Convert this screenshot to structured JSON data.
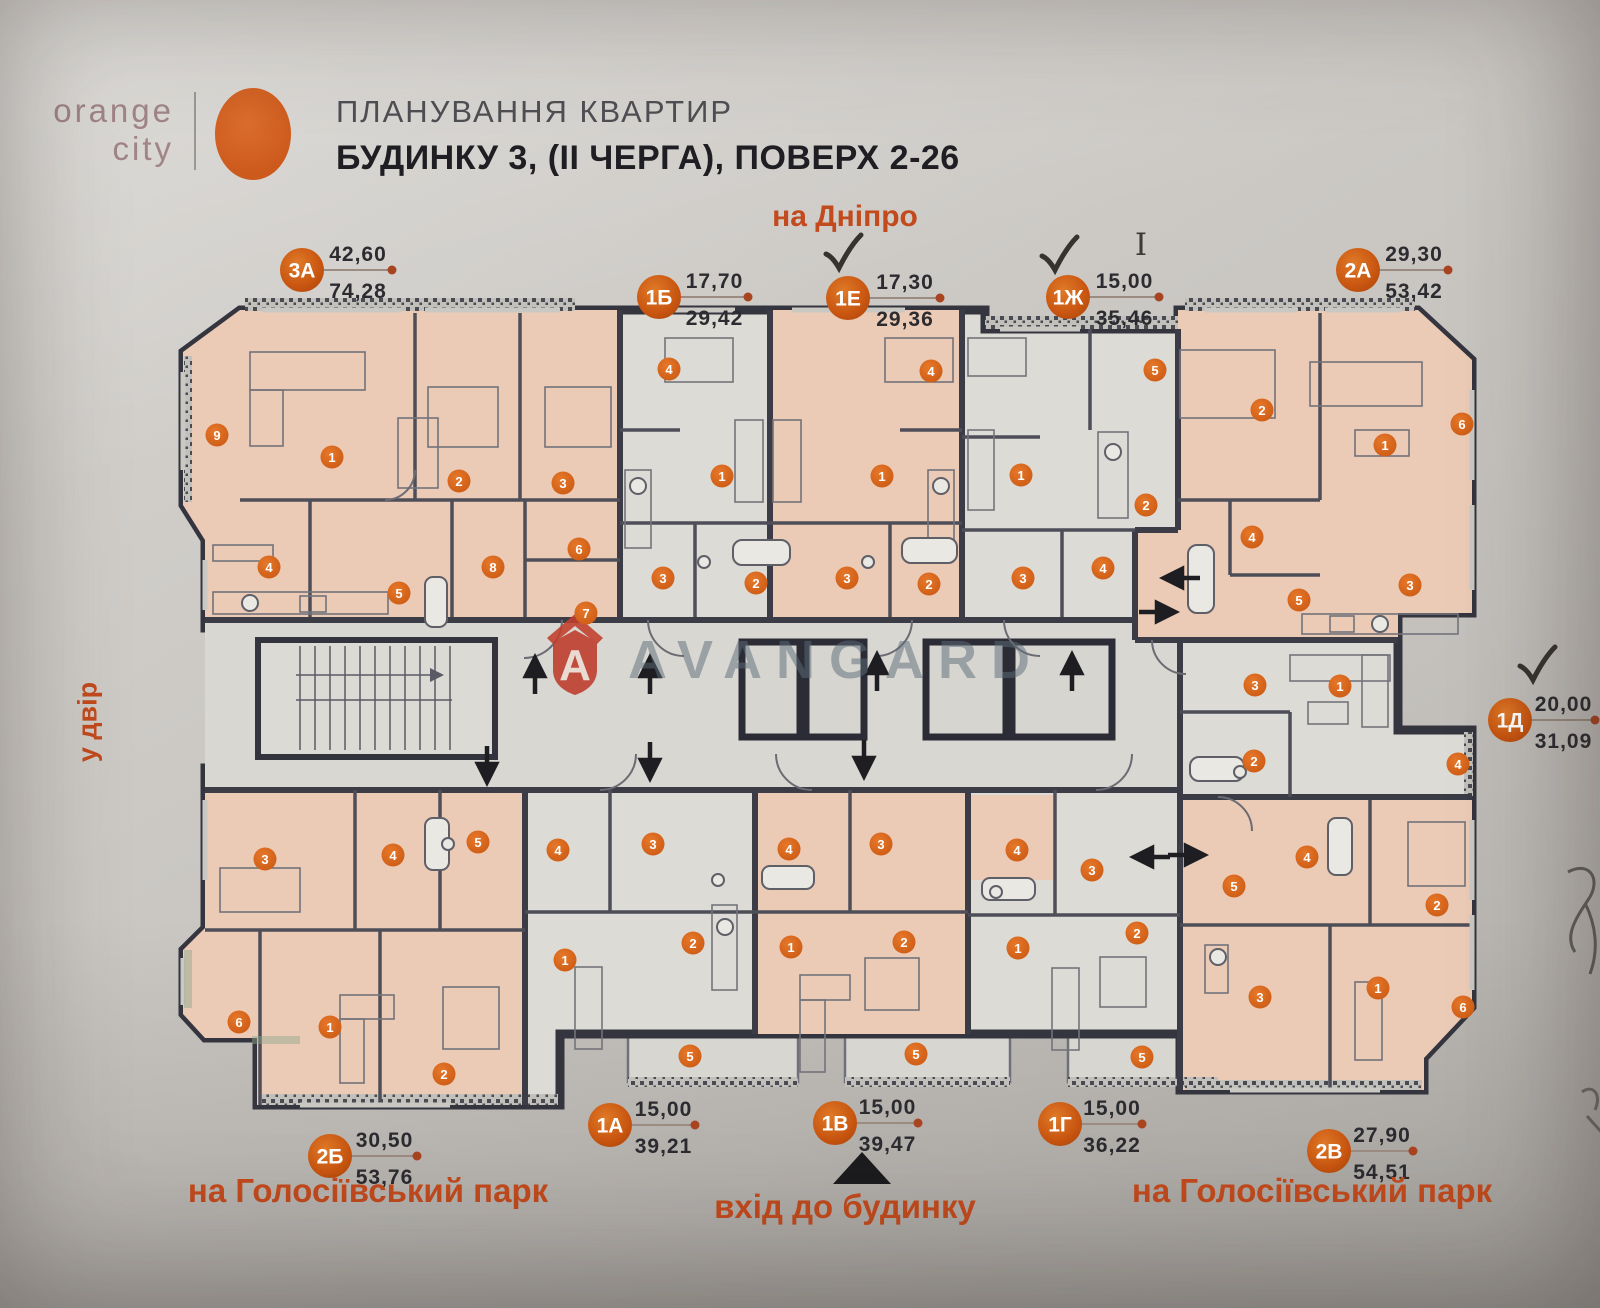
{
  "header": {
    "logo": {
      "line1": "orange",
      "line2": "city"
    },
    "title_line1": "ПЛАНУВАННЯ КВАРТИР",
    "title_line2": "БУДИНКУ 3, (II ЧЕРГА), ПОВЕРХ 2-26"
  },
  "directions": {
    "top": "на Дніпро",
    "left": "у двір",
    "bottom_left": "на Голосіївський парк",
    "bottom_center": "вхід до будинку",
    "bottom_right": "на Голосіївський парк"
  },
  "watermark": {
    "text": "AVANGARD",
    "shield_letter": "A"
  },
  "annotations": {
    "handwritten_mark": "I"
  },
  "colors": {
    "accent_orange": "#cf5a1e",
    "badge_orange": "#c85510",
    "direction_text": "#c24a1d",
    "wall_dark": "#3a3a45",
    "apartment_pink": "#ebcab6",
    "paper_gray": "#c9c7c3",
    "watermark_gray": "#5f6e78",
    "watermark_red": "#bd3b2a"
  },
  "apartments": [
    {
      "id": "3А",
      "area_top": "42,60",
      "area_bottom": "74,28",
      "cx": 302,
      "cy": 270,
      "dot_x": 392,
      "check": null,
      "rooms": [
        [
          9,
          217,
          435
        ],
        [
          1,
          332,
          457
        ],
        [
          2,
          459,
          481
        ],
        [
          3,
          563,
          483
        ],
        [
          4,
          269,
          567
        ],
        [
          8,
          493,
          567
        ],
        [
          5,
          399,
          593
        ],
        [
          6,
          579,
          549
        ],
        [
          7,
          586,
          613
        ]
      ]
    },
    {
      "id": "1Б",
      "area_top": "17,70",
      "area_bottom": "29,42",
      "cx": 659,
      "cy": 297,
      "dot_x": 748,
      "check": null,
      "rooms": [
        [
          4,
          669,
          369
        ],
        [
          1,
          722,
          476
        ],
        [
          3,
          663,
          578
        ],
        [
          2,
          756,
          583
        ]
      ]
    },
    {
      "id": "1Е",
      "area_top": "17,30",
      "area_bottom": "29,36",
      "cx": 848,
      "cy": 298,
      "dot_x": 940,
      "check": [
        842,
        248
      ],
      "rooms": [
        [
          4,
          931,
          371
        ],
        [
          1,
          882,
          476
        ],
        [
          3,
          847,
          578
        ],
        [
          2,
          929,
          584
        ]
      ]
    },
    {
      "id": "1Ж",
      "area_top": "15,00",
      "area_bottom": "35,46",
      "cx": 1068,
      "cy": 297,
      "dot_x": 1159,
      "check": [
        1058,
        250
      ],
      "rooms": [
        [
          5,
          1155,
          370
        ],
        [
          1,
          1021,
          475
        ],
        [
          2,
          1146,
          505
        ],
        [
          4,
          1103,
          568
        ],
        [
          3,
          1023,
          578
        ]
      ]
    },
    {
      "id": "2А",
      "area_top": "29,30",
      "area_bottom": "53,42",
      "cx": 1358,
      "cy": 270,
      "dot_x": 1448,
      "check": null,
      "rooms": [
        [
          2,
          1262,
          410
        ],
        [
          1,
          1385,
          445
        ],
        [
          6,
          1462,
          424
        ],
        [
          4,
          1252,
          537
        ],
        [
          3,
          1410,
          585
        ],
        [
          5,
          1299,
          600
        ]
      ]
    },
    {
      "id": "1Д",
      "area_top": "20,00",
      "area_bottom": "31,09",
      "cx": 1510,
      "cy": 720,
      "dot_x": 1595,
      "check": [
        1536,
        660
      ],
      "rooms": [
        [
          3,
          1255,
          685
        ],
        [
          1,
          1340,
          686
        ],
        [
          2,
          1254,
          761
        ],
        [
          4,
          1458,
          764
        ]
      ]
    },
    {
      "id": "2Б",
      "area_top": "30,50",
      "area_bottom": "53,76",
      "cx": 330,
      "cy": 1156,
      "dot_x": 417,
      "check": null,
      "rooms": [
        [
          3,
          265,
          859
        ],
        [
          4,
          393,
          855
        ],
        [
          5,
          478,
          842
        ],
        [
          6,
          239,
          1022
        ],
        [
          1,
          330,
          1027
        ],
        [
          2,
          444,
          1074
        ]
      ]
    },
    {
      "id": "1А",
      "area_top": "15,00",
      "area_bottom": "39,21",
      "cx": 610,
      "cy": 1125,
      "dot_x": 695,
      "check": null,
      "rooms": [
        [
          4,
          558,
          850
        ],
        [
          3,
          653,
          844
        ],
        [
          2,
          693,
          943
        ],
        [
          1,
          565,
          960
        ],
        [
          5,
          690,
          1056
        ]
      ]
    },
    {
      "id": "1В",
      "area_top": "15,00",
      "area_bottom": "39,47",
      "cx": 835,
      "cy": 1123,
      "dot_x": 918,
      "check": null,
      "rooms": [
        [
          4,
          789,
          849
        ],
        [
          3,
          881,
          844
        ],
        [
          1,
          791,
          947
        ],
        [
          2,
          904,
          942
        ],
        [
          5,
          916,
          1054
        ]
      ]
    },
    {
      "id": "1Г",
      "area_top": "15,00",
      "area_bottom": "36,22",
      "cx": 1060,
      "cy": 1124,
      "dot_x": 1142,
      "check": null,
      "rooms": [
        [
          4,
          1017,
          850
        ],
        [
          3,
          1092,
          870
        ],
        [
          2,
          1137,
          933
        ],
        [
          1,
          1018,
          948
        ],
        [
          5,
          1142,
          1057
        ]
      ]
    },
    {
      "id": "2В",
      "area_top": "27,90",
      "area_bottom": "54,51",
      "cx": 1329,
      "cy": 1151,
      "dot_x": 1413,
      "check": null,
      "rooms": [
        [
          5,
          1234,
          886
        ],
        [
          4,
          1307,
          857
        ],
        [
          2,
          1437,
          905
        ],
        [
          3,
          1260,
          997
        ],
        [
          1,
          1378,
          988
        ],
        [
          6,
          1463,
          1007
        ]
      ]
    }
  ]
}
